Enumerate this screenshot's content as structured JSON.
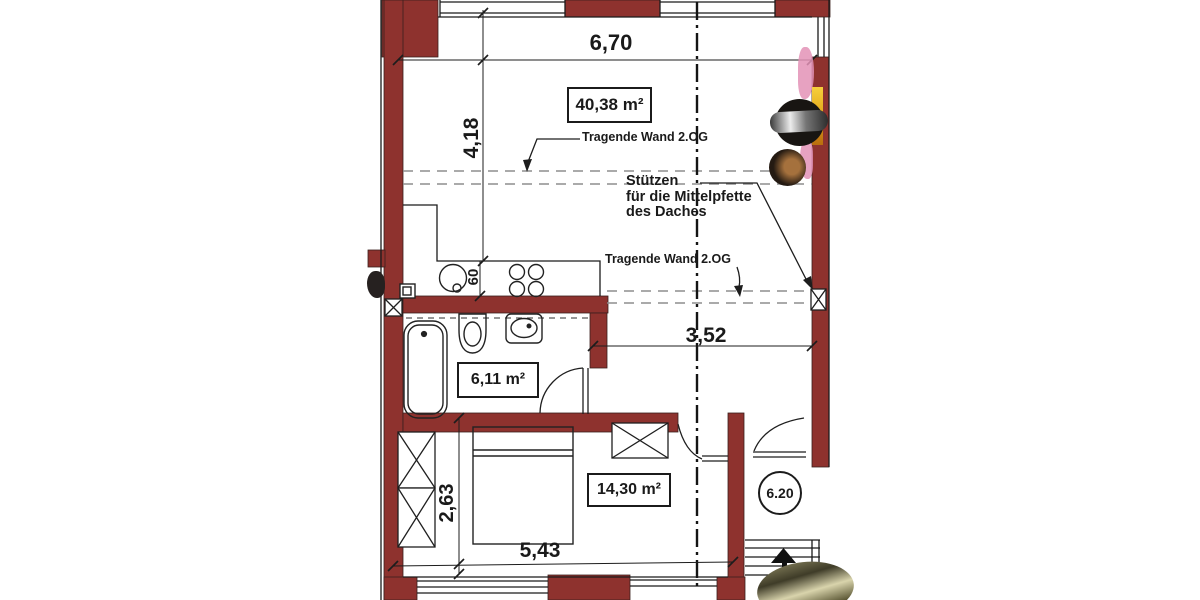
{
  "meta": {
    "drawing_type": "Grundriss / floor plan photo"
  },
  "colors": {
    "wall": "#8e322e",
    "line": "#1b1b1b",
    "dash_gray": "#8d8d8d",
    "tape_pink": "#e392b6",
    "wood_yellow": "#e3a81c"
  },
  "labels": {
    "dim_width_top": "6,70",
    "dim_height_left": "4,18",
    "dim_counter_depth": "60",
    "dim_hall_width": "3,52",
    "dim_bedroom_height": "2,63",
    "dim_bedroom_width": "5,43",
    "area_living": "40,38 m²",
    "area_bath": "6,11 m²",
    "area_bedroom": "14,30 m²",
    "room_number": "6.20",
    "note_load_wall_upper": "Tragende Wand 2.OG",
    "note_load_wall_lower": "Tragende Wand 2.OG",
    "note_support_line1": "Stützen",
    "note_support_line2": "für die Mittelpfette",
    "note_support_line3": "des Daches"
  }
}
